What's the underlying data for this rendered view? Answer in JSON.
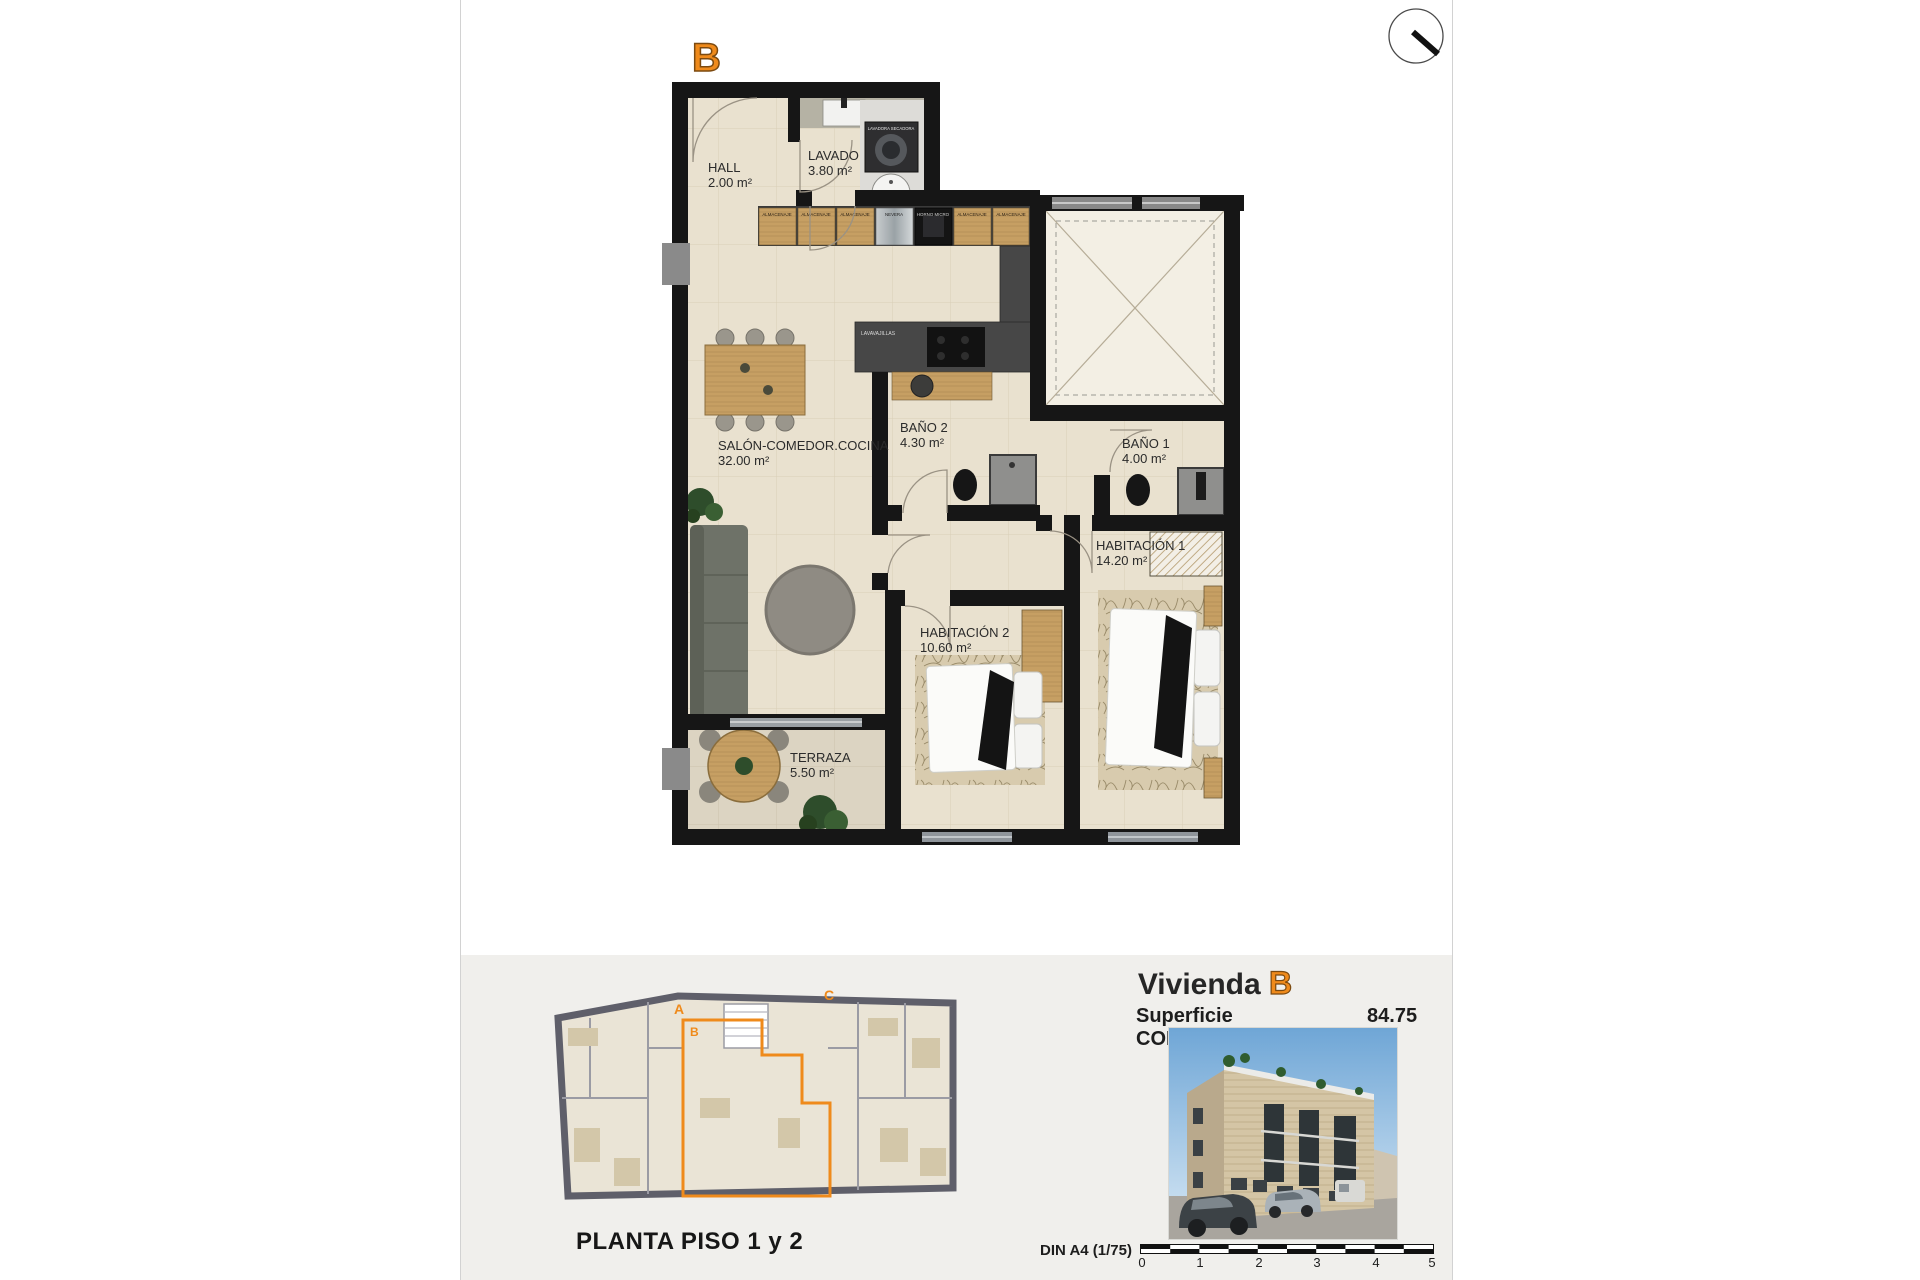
{
  "page": {
    "unit_badge": "B"
  },
  "floor_plan": {
    "rooms": [
      {
        "name": "HALL",
        "area": "2.00 m²"
      },
      {
        "name": "LAVADO",
        "area": "3.80 m²"
      },
      {
        "name": "SALÓN-COMEDOR.COCINA",
        "area": "32.00 m²"
      },
      {
        "name": "BAÑO 2",
        "area": "4.30 m²"
      },
      {
        "name": "BAÑO 1",
        "area": "4.00 m²"
      },
      {
        "name": "HABITACIÓN 1",
        "area": "14.20 m²"
      },
      {
        "name": "HABITACIÓN 2",
        "area": "10.60 m²"
      },
      {
        "name": "TERRAZA",
        "area": "5.50 m²"
      }
    ],
    "kitchen_units": [
      "ALMACENAJE",
      "ALMACENAJE",
      "ALMACENAJE",
      "NEVERA",
      "HORNO MICRO",
      "ALMACENAJE",
      "ALMACENAJE"
    ],
    "fixtures": {
      "dishwasher": "LAVAVAJILLAS",
      "washer": "LAVADORA SECADORA",
      "heat_pump": "AEROTERMIA"
    },
    "accent_color": "#ef8a1b"
  },
  "footer": {
    "plan_caption": "PLANTA PISO 1 y 2",
    "overview_units": [
      "A",
      "B",
      "C"
    ],
    "title_prefix": "Vivienda",
    "title_unit": "B",
    "surface_label": "Superficie CONSTRUIDA",
    "surface_value": "84.75 m²",
    "scale_label": "DIN A4 (1/75)",
    "scale_ticks": [
      "0",
      "1",
      "2",
      "3",
      "4",
      "5"
    ]
  }
}
